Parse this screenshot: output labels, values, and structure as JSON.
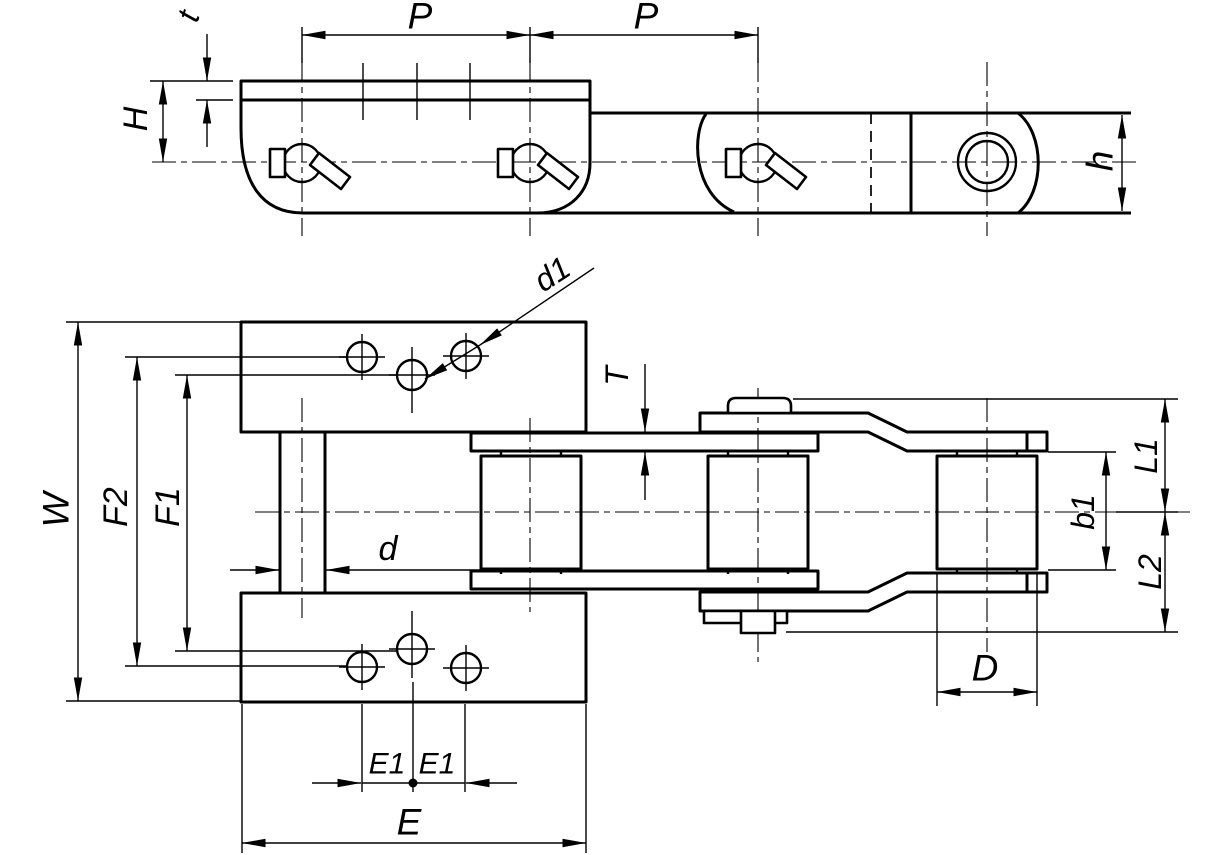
{
  "page": {
    "background": "#ffffff",
    "line_color": "#000000"
  },
  "drawing": {
    "kind": "engineering-drawing",
    "subject": "conveyor chain with attachment link, side elevation and plan view",
    "views": {
      "side_view": "side elevation of chain links with cotter pins",
      "plan_view": "plan view with attachment plates, rollers and cranked link"
    },
    "dims": {
      "P1": "P",
      "P2": "P",
      "t": "t",
      "H": "H",
      "h": "h",
      "d1": "d1",
      "T": "T",
      "W": "W",
      "F2": "F2",
      "F1": "F1",
      "d": "d",
      "E1a": "E1",
      "E1b": "E1",
      "E": "E",
      "D": "D",
      "b1": "b1",
      "L1": "L1",
      "L2": "L2"
    }
  }
}
